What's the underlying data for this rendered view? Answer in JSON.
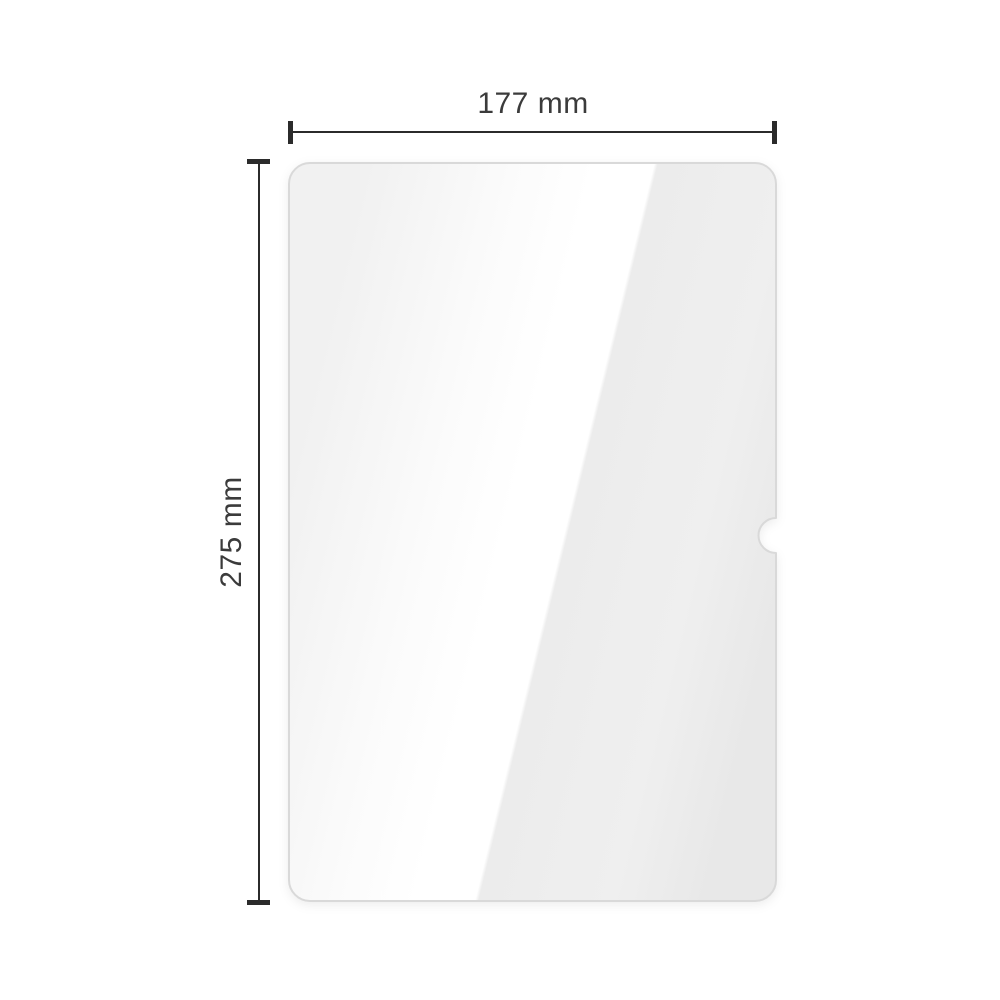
{
  "diagram": {
    "width_label": "177 mm",
    "height_label": "275 mm",
    "subject": "tablet-screen-protector-glass-with-camera-notch"
  },
  "colors": {
    "background": "#ffffff",
    "dimension_line": "#2b2b2b",
    "label_text": "#3b3b3b",
    "glass_border": "#d9d9d9",
    "glass_edge_left": "#f1f1f1",
    "glass_soft_white": "#fbfbfb",
    "glass_highlight": "#ffffff",
    "glass_right_near": "#ececec",
    "glass_right_mid": "#efefef",
    "glass_edge_right": "#e8e8e8"
  }
}
